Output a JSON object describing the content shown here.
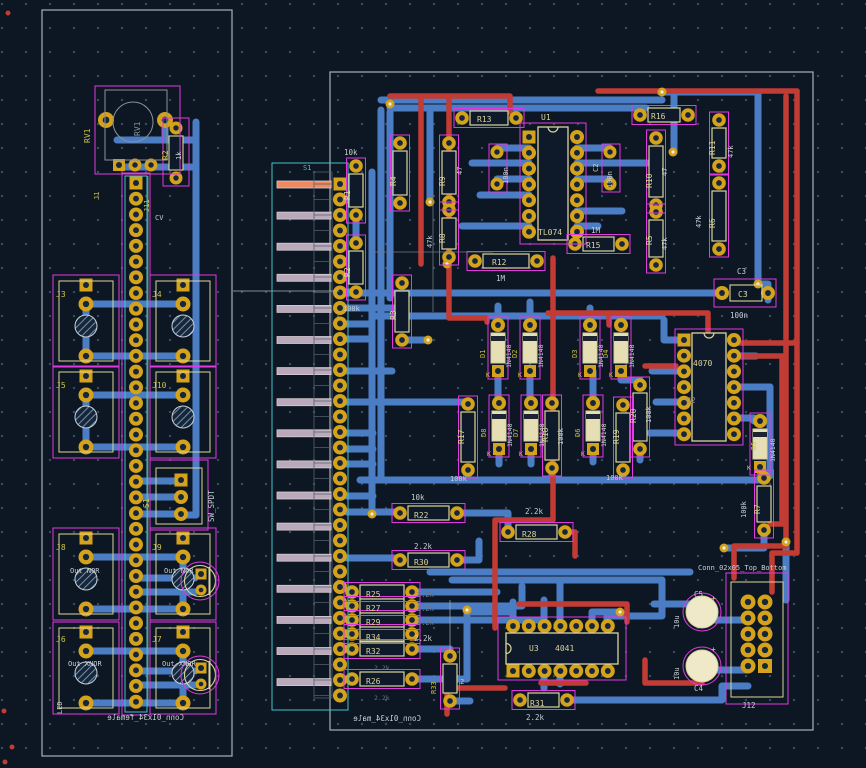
{
  "palette": {
    "bg": "#0d1724",
    "grid": "#3a4b5f",
    "blue": "#4a7dc3",
    "red": "#c23b35",
    "gold": "#d5a21b",
    "hole": "#16273c",
    "silk": "#dcd49c",
    "ref": "#cfc23e",
    "white": "#c9ced3",
    "fab": "#8b9298",
    "cyan": "#44c3c7",
    "dim": "#66748a",
    "magenta": "#e139e1",
    "edge": "#a9b0b5",
    "finger": "#b9a9bb",
    "finger_hl": "#ed8a60",
    "body": "#0e1a29",
    "diode_body": "#e6dfb6",
    "cap_body": "#efe9c8"
  },
  "boards": {
    "left": {
      "silkscreen_name": "Conn_01x34_female"
    },
    "right": {
      "silkscreen_name": "Conn_01x34_male"
    }
  },
  "labels": [
    {
      "n": "rv1-ref",
      "t": "RV1",
      "x": 90,
      "y": 143,
      "c": "ref",
      "r": -90
    },
    {
      "n": "rv1-fab",
      "t": "RV1",
      "x": 140,
      "y": 136,
      "c": "fab",
      "r": -90
    },
    {
      "n": "r2l-ref",
      "t": "R2",
      "x": 168,
      "y": 160,
      "c": "ref",
      "r": -90
    },
    {
      "n": "r2l-val",
      "t": "1k",
      "x": 181,
      "y": 160,
      "c": "white",
      "r": -90,
      "s": 7
    },
    {
      "n": "j1-ref",
      "t": "J1",
      "x": 99,
      "y": 200,
      "c": "ref",
      "r": -90,
      "s": 7
    },
    {
      "n": "j11-ref",
      "t": "J11",
      "x": 149,
      "y": 212,
      "c": "ref",
      "r": -90,
      "s": 7
    },
    {
      "n": "cv-text",
      "t": "CV",
      "x": 155,
      "y": 220,
      "c": "white",
      "s": 7
    },
    {
      "n": "j3-ref",
      "t": "J3",
      "x": 56,
      "y": 297,
      "c": "ref"
    },
    {
      "n": "j4-ref",
      "t": "J4",
      "x": 152,
      "y": 297,
      "c": "ref"
    },
    {
      "n": "j5-ref",
      "t": "J5",
      "x": 56,
      "y": 388,
      "c": "ref"
    },
    {
      "n": "j10-ref",
      "t": "J10",
      "x": 152,
      "y": 388,
      "c": "ref"
    },
    {
      "n": "j8-ref",
      "t": "J8",
      "x": 56,
      "y": 550,
      "c": "ref"
    },
    {
      "n": "j9-ref",
      "t": "J9",
      "x": 152,
      "y": 550,
      "c": "ref"
    },
    {
      "n": "j6-ref",
      "t": "J6",
      "x": 56,
      "y": 642,
      "c": "ref"
    },
    {
      "n": "j7-ref",
      "t": "J7",
      "x": 152,
      "y": 642,
      "c": "ref"
    },
    {
      "n": "out-nor-1",
      "t": "Out NOR",
      "x": 70,
      "y": 573,
      "c": "white",
      "s": 7
    },
    {
      "n": "out-nor-2",
      "t": "Out NOR",
      "x": 164,
      "y": 573,
      "c": "white",
      "s": 7
    },
    {
      "n": "out-xnor-1",
      "t": "Out XNOR",
      "x": 68,
      "y": 666,
      "c": "white",
      "s": 7
    },
    {
      "n": "out-xnor-2",
      "t": "Out XNOR",
      "x": 162,
      "y": 666,
      "c": "white",
      "s": 7
    },
    {
      "n": "s1l-ref",
      "t": "S1",
      "x": 149,
      "y": 508,
      "c": "ref",
      "r": -90
    },
    {
      "n": "sw-spdt-val",
      "t": "SW_SPDT",
      "x": 214,
      "y": 522,
      "c": "white",
      "r": -90,
      "s": 7.5
    },
    {
      "n": "led-text",
      "t": "LED",
      "x": 62,
      "y": 714,
      "c": "white",
      "r": -90,
      "s": 7
    },
    {
      "n": "conn-female",
      "t": "Conn_01x34_female",
      "x": 184,
      "y": 720,
      "c": "white",
      "m": 1,
      "s": 7.5
    },
    {
      "n": "s1r-ref",
      "t": "S1",
      "x": 303,
      "y": 170,
      "c": "cyan",
      "s": 7
    },
    {
      "n": "r1-val",
      "t": "10k",
      "x": 344,
      "y": 155,
      "c": "white",
      "s": 7.5
    },
    {
      "n": "r1-ref",
      "t": "R1",
      "x": 350,
      "y": 200,
      "r": -90
    },
    {
      "n": "r2r-ref",
      "t": "R2",
      "x": 350,
      "y": 277,
      "r": -90
    },
    {
      "n": "r2r-val",
      "t": "100k",
      "x": 343,
      "y": 311,
      "c": "white",
      "s": 7
    },
    {
      "n": "r3-ref",
      "t": "R3",
      "x": 396,
      "y": 320,
      "r": -90
    },
    {
      "n": "r13-ref",
      "t": "R13",
      "x": 477,
      "y": 122
    },
    {
      "n": "u1-ref",
      "t": "U1",
      "x": 541,
      "y": 120
    },
    {
      "n": "u1-val",
      "t": "TL074",
      "x": 538,
      "y": 235
    },
    {
      "n": "c1-val",
      "t": "100n",
      "x": 508,
      "y": 184,
      "c": "white",
      "r": -90,
      "s": 7
    },
    {
      "n": "c2-ref",
      "t": "C2",
      "x": 598,
      "y": 172,
      "r": -90,
      "s": 7
    },
    {
      "n": "c2-val",
      "t": "100n",
      "x": 612,
      "y": 188,
      "c": "white",
      "r": -90,
      "s": 7
    },
    {
      "n": "r16-ref",
      "t": "R16",
      "x": 651,
      "y": 119
    },
    {
      "n": "r11-ref",
      "t": "R11",
      "x": 715,
      "y": 155,
      "r": -90
    },
    {
      "n": "r11-val",
      "t": "47k",
      "x": 733,
      "y": 158,
      "c": "white",
      "r": -90,
      "s": 7
    },
    {
      "n": "r10-ref",
      "t": "R10",
      "x": 652,
      "y": 188,
      "r": -90
    },
    {
      "n": "r10-val",
      "t": "47",
      "x": 667,
      "y": 176,
      "c": "white",
      "r": -90,
      "s": 7
    },
    {
      "n": "r5-ref",
      "t": "R5",
      "x": 652,
      "y": 245,
      "r": -90
    },
    {
      "n": "r5-val",
      "t": "47k",
      "x": 667,
      "y": 250,
      "c": "white",
      "r": -90,
      "s": 7
    },
    {
      "n": "r6-ref",
      "t": "R6",
      "x": 715,
      "y": 228,
      "r": -90
    },
    {
      "n": "r6-val",
      "t": "47k",
      "x": 701,
      "y": 228,
      "c": "white",
      "r": -90,
      "s": 7
    },
    {
      "n": "r4-ref",
      "t": "R4",
      "x": 396,
      "y": 186,
      "r": -90
    },
    {
      "n": "r9-ref",
      "t": "R9",
      "x": 445,
      "y": 186,
      "r": -90
    },
    {
      "n": "r9-val",
      "t": "47",
      "x": 462,
      "y": 175,
      "c": "white",
      "r": -90,
      "s": 7
    },
    {
      "n": "r8-ref",
      "t": "R8",
      "x": 445,
      "y": 243,
      "r": -90
    },
    {
      "n": "r8-val",
      "t": "47k",
      "x": 432,
      "y": 248,
      "c": "white",
      "r": -90,
      "s": 7
    },
    {
      "n": "r15-ref",
      "t": "R15",
      "x": 586,
      "y": 248
    },
    {
      "n": "r15-val",
      "t": "1M",
      "x": 591,
      "y": 233,
      "c": "white",
      "s": 7.5
    },
    {
      "n": "r12-ref",
      "t": "R12",
      "x": 492,
      "y": 265
    },
    {
      "n": "r12-val",
      "t": "1M",
      "x": 496,
      "y": 281,
      "c": "white",
      "s": 7.5
    },
    {
      "n": "c3-lbl",
      "t": "C3",
      "x": 737,
      "y": 274,
      "c": "white",
      "s": 7.5
    },
    {
      "n": "c3-ref",
      "t": "C3",
      "x": 738,
      "y": 297
    },
    {
      "n": "c3-val",
      "t": "100n",
      "x": 730,
      "y": 318,
      "c": "white",
      "s": 7.5
    },
    {
      "n": "d1-ref",
      "t": "D1",
      "x": 485,
      "y": 358,
      "c": "ref",
      "r": -90,
      "s": 7
    },
    {
      "n": "d1-val",
      "t": "1N4148",
      "x": 511,
      "y": 368,
      "c": "white",
      "r": -90,
      "s": 6.5
    },
    {
      "n": "d1-k",
      "t": "K",
      "x": 486,
      "y": 377,
      "c": "ref",
      "s": 6.5
    },
    {
      "n": "d2-ref",
      "t": "D2",
      "x": 517,
      "y": 358,
      "c": "ref",
      "r": -90,
      "s": 7
    },
    {
      "n": "d2-val",
      "t": "1N4148",
      "x": 543,
      "y": 368,
      "c": "white",
      "r": -90,
      "s": 6.5
    },
    {
      "n": "d2-k",
      "t": "K",
      "x": 518,
      "y": 377,
      "c": "ref",
      "s": 6.5
    },
    {
      "n": "d3-ref",
      "t": "D3",
      "x": 577,
      "y": 358,
      "c": "ref",
      "r": -90,
      "s": 7
    },
    {
      "n": "d3-val",
      "t": "1N4148",
      "x": 603,
      "y": 368,
      "c": "white",
      "r": -90,
      "s": 6.5
    },
    {
      "n": "d3-k",
      "t": "K",
      "x": 578,
      "y": 377,
      "c": "ref",
      "s": 6.5
    },
    {
      "n": "d4-ref",
      "t": "D4",
      "x": 608,
      "y": 358,
      "c": "ref",
      "r": -90,
      "s": 7
    },
    {
      "n": "d4-val",
      "t": "1N4148",
      "x": 634,
      "y": 368,
      "c": "white",
      "r": -90,
      "s": 6.5
    },
    {
      "n": "d4-k",
      "t": "K",
      "x": 609,
      "y": 377,
      "c": "ref",
      "s": 6.5
    },
    {
      "n": "d8-ref",
      "t": "D8",
      "x": 486,
      "y": 437,
      "c": "ref",
      "r": -90,
      "s": 7
    },
    {
      "n": "d8-val",
      "t": "1N4148",
      "x": 512,
      "y": 447,
      "c": "white",
      "r": -90,
      "s": 6.5
    },
    {
      "n": "d8-k",
      "t": "K",
      "x": 487,
      "y": 456,
      "c": "ref",
      "s": 6.5
    },
    {
      "n": "d7-ref",
      "t": "D7",
      "x": 518,
      "y": 437,
      "c": "ref",
      "r": -90,
      "s": 7
    },
    {
      "n": "d7-val",
      "t": "1N4148",
      "x": 544,
      "y": 447,
      "c": "white",
      "r": -90,
      "s": 6.5
    },
    {
      "n": "d7-k",
      "t": "K",
      "x": 519,
      "y": 456,
      "c": "ref",
      "s": 6.5
    },
    {
      "n": "d6-ref",
      "t": "D6",
      "x": 580,
      "y": 437,
      "c": "ref",
      "r": -90,
      "s": 7
    },
    {
      "n": "d6-val",
      "t": "1N4148",
      "x": 606,
      "y": 447,
      "c": "white",
      "r": -90,
      "s": 6.5
    },
    {
      "n": "d6-k",
      "t": "K",
      "x": 581,
      "y": 456,
      "c": "ref",
      "s": 6.5
    },
    {
      "n": "r17-ref",
      "t": "R17",
      "x": 464,
      "y": 444,
      "r": -90
    },
    {
      "n": "r17-val",
      "t": "100k",
      "x": 450,
      "y": 481,
      "c": "white",
      "s": 7
    },
    {
      "n": "r18-ref",
      "t": "R18",
      "x": 548,
      "y": 442,
      "r": -90
    },
    {
      "n": "r18-val",
      "t": "100k",
      "x": 563,
      "y": 445,
      "c": "white",
      "r": -90,
      "s": 7
    },
    {
      "n": "r19-ref",
      "t": "R19",
      "x": 619,
      "y": 444,
      "r": -90
    },
    {
      "n": "r19-val",
      "t": "100k",
      "x": 606,
      "y": 480,
      "c": "white",
      "s": 7
    },
    {
      "n": "r20-ref",
      "t": "R20",
      "x": 636,
      "y": 423,
      "r": -90
    },
    {
      "n": "r20-val",
      "t": "100k",
      "x": 651,
      "y": 423,
      "c": "white",
      "r": -90,
      "s": 7
    },
    {
      "n": "u2-val",
      "t": "4070",
      "x": 693,
      "y": 366
    },
    {
      "n": "u2-ref",
      "t": "U2",
      "x": 686,
      "y": 403,
      "c": "fab"
    },
    {
      "n": "d5-ref",
      "t": "D5",
      "x": 756,
      "y": 450,
      "c": "ref",
      "r": -90,
      "s": 7
    },
    {
      "n": "d5-val",
      "t": "1N4148",
      "x": 775,
      "y": 462,
      "c": "white",
      "r": -90,
      "s": 6.5
    },
    {
      "n": "d5-k",
      "t": "K",
      "x": 747,
      "y": 470,
      "c": "ref",
      "s": 6.5
    },
    {
      "n": "r7-ref",
      "t": "R7",
      "x": 760,
      "y": 514,
      "r": -90
    },
    {
      "n": "r7-val",
      "t": "100k",
      "x": 746,
      "y": 518,
      "c": "white",
      "r": -90,
      "s": 7
    },
    {
      "n": "r22-ref",
      "t": "R22",
      "x": 414,
      "y": 518
    },
    {
      "n": "r22-val",
      "t": "10k",
      "x": 411,
      "y": 500,
      "c": "white",
      "s": 7.5
    },
    {
      "n": "r28-ref",
      "t": "R28",
      "x": 522,
      "y": 537
    },
    {
      "n": "r28-val",
      "t": "2.2k",
      "x": 525,
      "y": 514,
      "c": "white",
      "s": 7.5
    },
    {
      "n": "r30-ref",
      "t": "R30",
      "x": 414,
      "y": 565
    },
    {
      "n": "r30-val",
      "t": "2.2k",
      "x": 414,
      "y": 549,
      "c": "white",
      "s": 7.5
    },
    {
      "n": "r25-ref",
      "t": "R25",
      "x": 366,
      "y": 597
    },
    {
      "n": "r27-ref",
      "t": "R27",
      "x": 366,
      "y": 611
    },
    {
      "n": "r29-ref",
      "t": "R29",
      "x": 366,
      "y": 625
    },
    {
      "n": "r34-ref",
      "t": "R34",
      "x": 366,
      "y": 640
    },
    {
      "n": "r32-ref",
      "t": "R32",
      "x": 366,
      "y": 654
    },
    {
      "n": "r26-ref",
      "t": "R26",
      "x": 366,
      "y": 684
    },
    {
      "n": "r25-val",
      "t": "2.2k",
      "x": 417,
      "y": 597,
      "c": "dim",
      "s": 7
    },
    {
      "n": "r27-val",
      "t": "2.2k",
      "x": 417,
      "y": 611,
      "c": "dim",
      "s": 7
    },
    {
      "n": "r29-val",
      "t": "2.2k",
      "x": 417,
      "y": 625,
      "c": "dim",
      "s": 7
    },
    {
      "n": "r34-val",
      "t": "2.2k",
      "x": 414,
      "y": 641,
      "c": "white",
      "s": 7.5
    },
    {
      "n": "r32-val",
      "t": "2.2k",
      "x": 374,
      "y": 670,
      "c": "dim",
      "s": 6.5
    },
    {
      "n": "r26-val",
      "t": "2.2k",
      "x": 374,
      "y": 700,
      "c": "dim",
      "s": 6.5
    },
    {
      "n": "r33-ref",
      "t": "R33",
      "x": 436,
      "y": 694,
      "c": "ref",
      "r": -90,
      "s": 7
    },
    {
      "n": "r33-val",
      "t": "2",
      "x": 460,
      "y": 684,
      "c": "white",
      "s": 7
    },
    {
      "n": "u3-ref",
      "t": "U3",
      "x": 529,
      "y": 651
    },
    {
      "n": "u3-val",
      "t": "4041",
      "x": 555,
      "y": 651
    },
    {
      "n": "r31-ref",
      "t": "R31",
      "x": 530,
      "y": 706
    },
    {
      "n": "r31-val",
      "t": "2.2k",
      "x": 526,
      "y": 720,
      "c": "white",
      "s": 7.5
    },
    {
      "n": "c5-ref",
      "t": "C5",
      "x": 694,
      "y": 597,
      "c": "white",
      "s": 7.5
    },
    {
      "n": "c5-val",
      "t": "10u",
      "x": 679,
      "y": 628,
      "c": "white",
      "r": -90,
      "s": 7
    },
    {
      "n": "c5-plus",
      "t": "+",
      "x": 711,
      "y": 601,
      "c": "silk",
      "s": 8
    },
    {
      "n": "c4-ref",
      "t": "C4",
      "x": 694,
      "y": 691,
      "c": "white",
      "s": 7.5
    },
    {
      "n": "c4-val",
      "t": "10u",
      "x": 679,
      "y": 680,
      "c": "white",
      "r": -90,
      "s": 7
    },
    {
      "n": "c4-plus",
      "t": "+",
      "x": 711,
      "y": 652,
      "c": "silk",
      "s": 8
    },
    {
      "n": "j12-ref",
      "t": "J12",
      "x": 742,
      "y": 708,
      "c": "white",
      "s": 7.5
    },
    {
      "n": "j12-val",
      "t": "Conn_02x05_Top_Bottom",
      "x": 698,
      "y": 570,
      "c": "white",
      "s": 7
    },
    {
      "n": "conn-male",
      "t": "Conn_01x34_male",
      "x": 421,
      "y": 721,
      "c": "white",
      "m": 1,
      "s": 7.5
    }
  ]
}
